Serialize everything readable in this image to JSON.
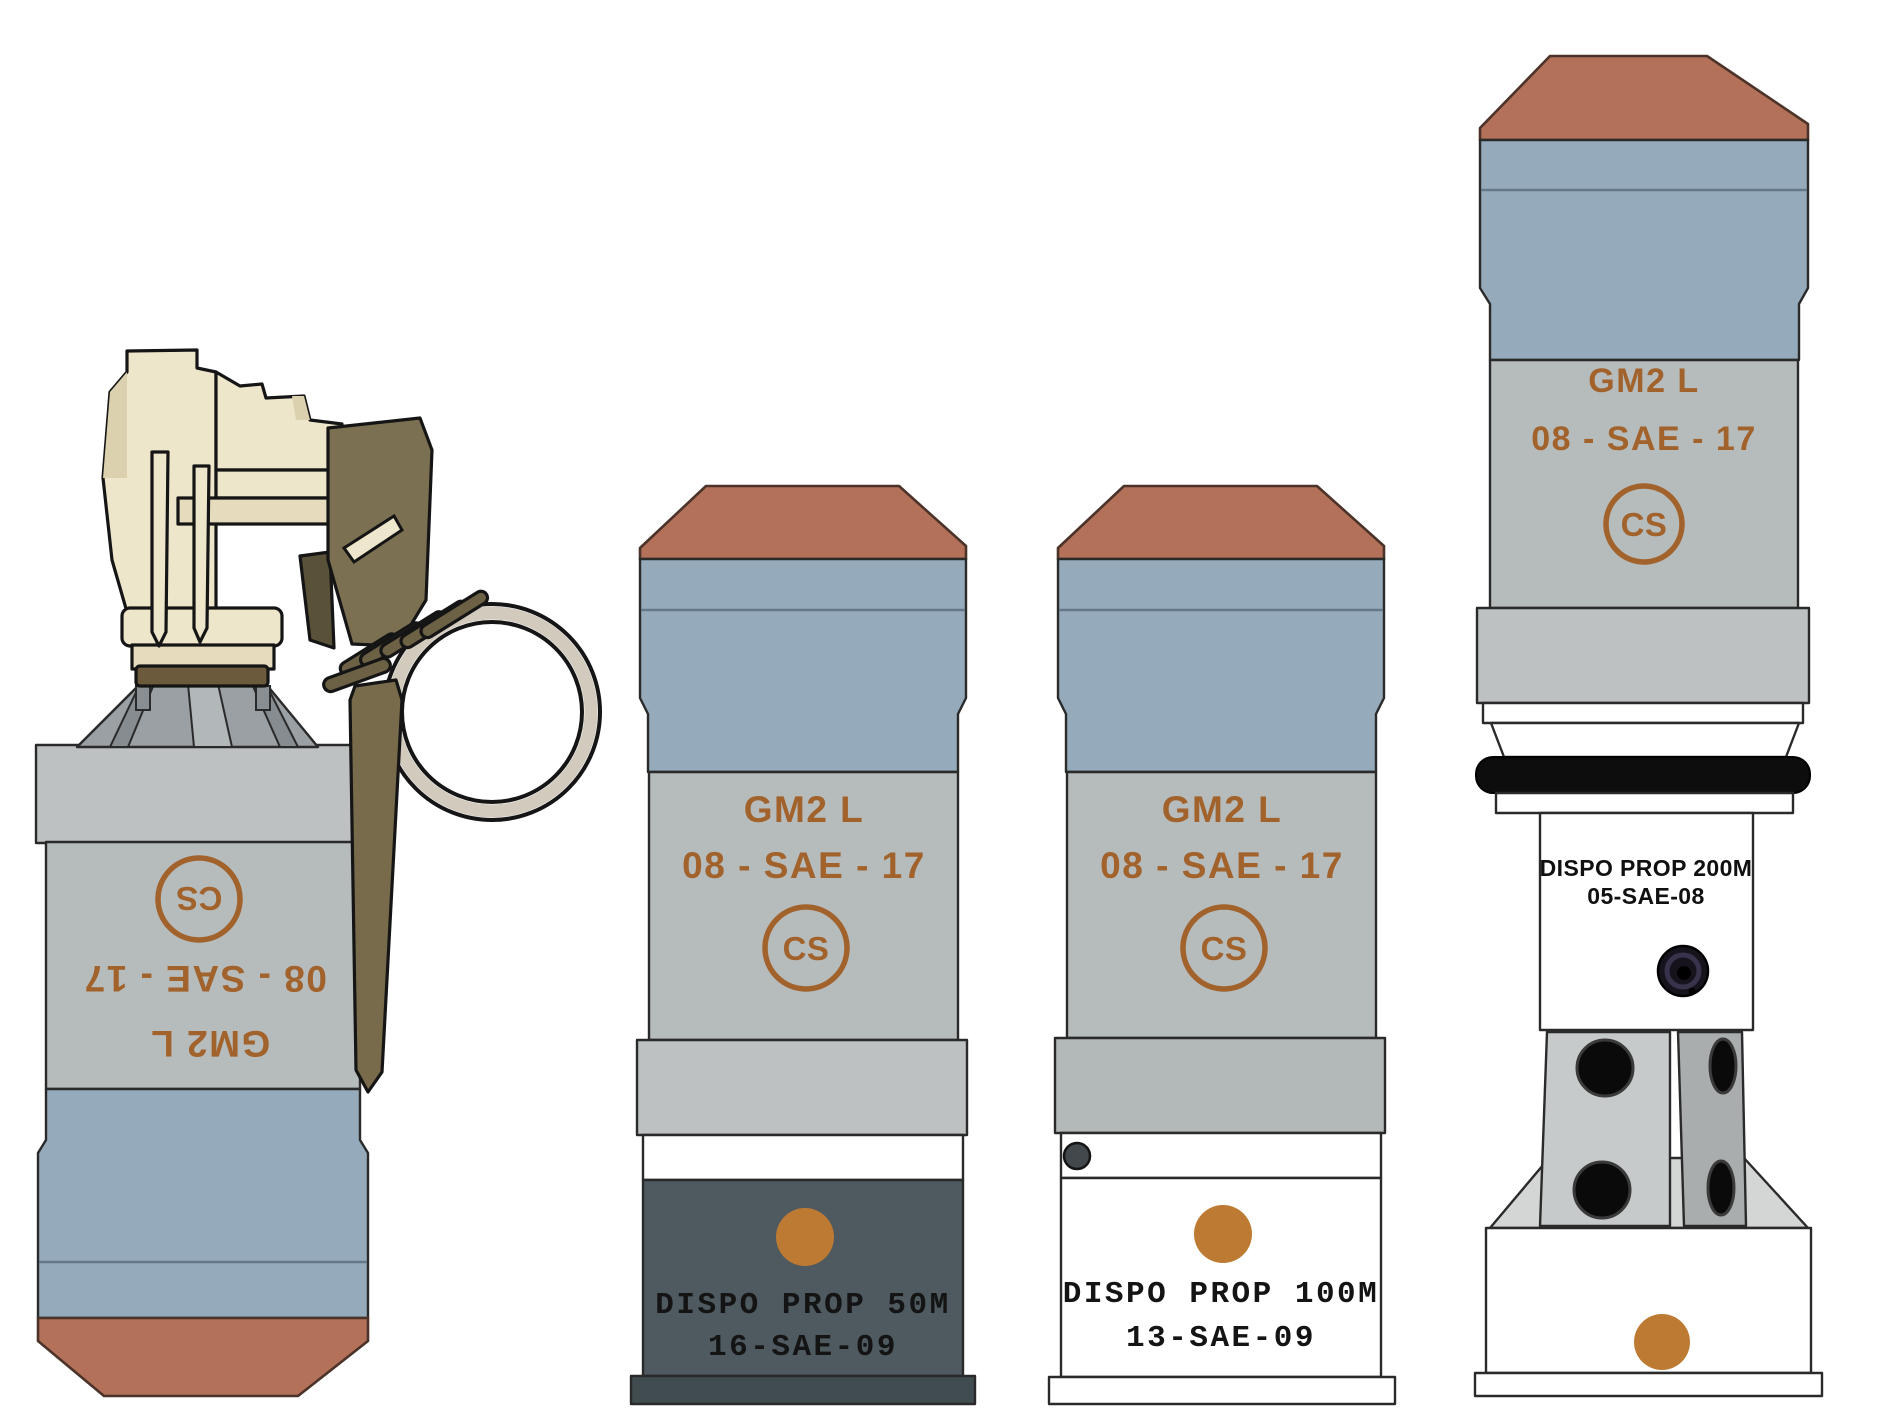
{
  "illustration": {
    "background": "#ffffff",
    "palette": {
      "cap_salmon": "#b37159",
      "blue_band": "#95aaba",
      "blue_band_line": "#65788a",
      "body_gray": "#b6bbbc",
      "collar_gray": "#bdc1c1",
      "stencil_brown": "#a2622b",
      "orange_dot": "#bd7a33",
      "dark_slate": "#4e5a5f",
      "slate_flange": "#414c50",
      "fuze_cream": "#eee6cb",
      "fuze_cream_shade": "#dbd1ae",
      "lever_olive": "#7b7052",
      "lever_olive_dark": "#6c6145",
      "ring_beige": "#d2cbbd",
      "cone_gray": "#9aa0a4",
      "white": "#ffffff",
      "black": "#0d0d0d"
    }
  },
  "grenades": [
    {
      "model": "GM2 L",
      "lot": "08 - SAE - 17",
      "agent": "CS"
    },
    {
      "model": "GM2 L",
      "lot": "08 - SAE - 17",
      "agent": "CS",
      "prop_label": "DISPO PROP 50M",
      "prop_lot": "16-SAE-09"
    },
    {
      "model": "GM2 L",
      "lot": "08 - SAE - 17",
      "agent": "CS",
      "prop_label": "DISPO PROP 100M",
      "prop_lot": "13-SAE-09"
    },
    {
      "model": "GM2 L",
      "lot": "08 - SAE - 17",
      "agent": "CS",
      "prop_label": "DISPO PROP 200M",
      "prop_lot": "05-SAE-08"
    }
  ]
}
